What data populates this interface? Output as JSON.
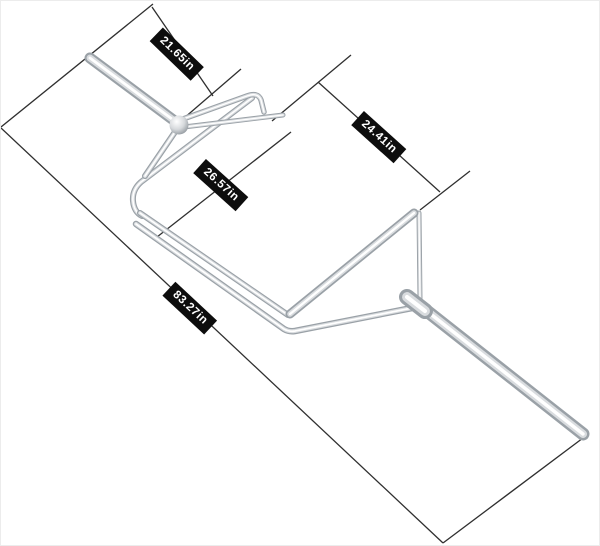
{
  "figure": {
    "description": "chrome open hex trap bar with dimension callouts",
    "background_color": "#ffffff",
    "dimension_line_color": "#2f2f2f",
    "label_bg_color": "#0d0d0d",
    "label_text_color": "#ffffff",
    "chrome_colors": {
      "edge": "#9aa1a7",
      "mid": "#d9dcdf",
      "highlight": "#ffffff"
    },
    "dimensions": [
      {
        "name": "left-sleeve-length",
        "label": "21.65in"
      },
      {
        "name": "handle-to-handle-span",
        "label": "24.41in"
      },
      {
        "name": "inner-frame-width",
        "label": "26.57in"
      },
      {
        "name": "overall-length",
        "label": "83.27in"
      }
    ]
  }
}
